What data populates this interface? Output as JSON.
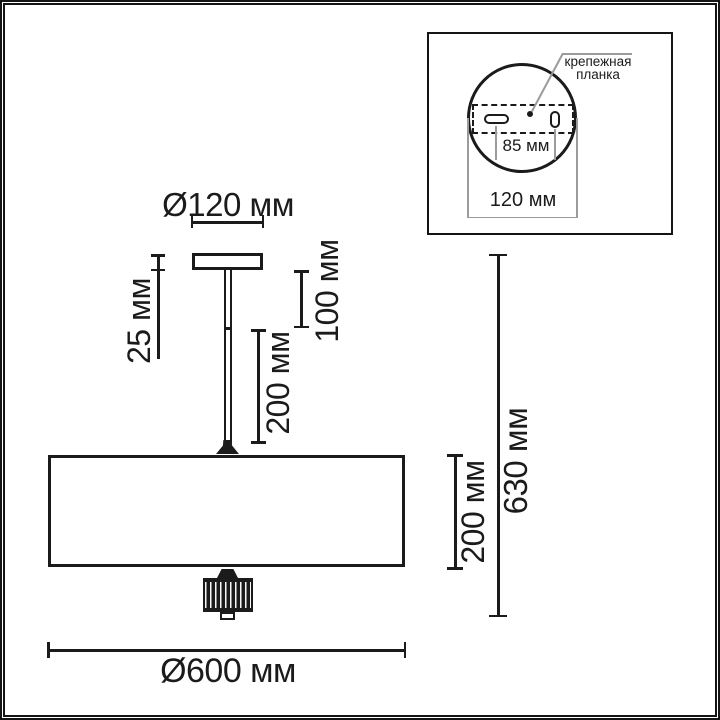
{
  "diagram": {
    "type": "technical-dimension-drawing",
    "subject": "ceiling pendant lamp: side elevation with overall dimensions and mounting-plate detail inset"
  },
  "colors": {
    "line": "#1b1b1b",
    "dim_gray": "#9b9b9b",
    "background": "#ffffff"
  },
  "main_view": {
    "dim_plate_diameter": "Ø120 мм",
    "dim_plate_height": "25 мм",
    "dim_rod_upper": "100 мм",
    "dim_rod_lower": "200 мм",
    "dim_shade_height": "200 мм",
    "dim_total_height": "630 мм",
    "dim_shade_diameter": "Ø600 мм"
  },
  "inset_view": {
    "label_lines": [
      "крепежная",
      "планка"
    ],
    "dim_hole_spacing": "85 мм",
    "dim_plate_diameter": "120 мм"
  }
}
